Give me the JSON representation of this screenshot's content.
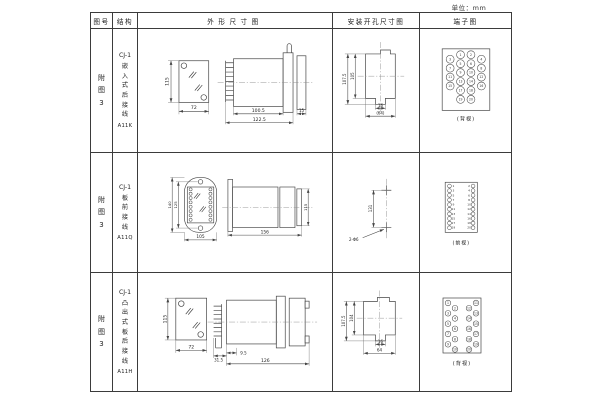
{
  "page": {
    "unit_label": "单位：mm"
  },
  "header": {
    "fig_no": "图号",
    "structure": "结构",
    "outline": "外形尺寸图",
    "mounting": "安装开孔尺寸图",
    "terminal": "端子图"
  },
  "rows": [
    {
      "fig": "附图3",
      "model": "CJ-1",
      "structure": "嵌入式后接线",
      "code": "A11K",
      "view_label": "(背视)",
      "dims": {
        "front_h": "115",
        "front_w": "72",
        "body": "100.5",
        "total": "122.5",
        "panel": "15",
        "cut_h1": "107.5",
        "cut_h2": "105",
        "slot": "16",
        "cut_w": "(64)"
      }
    },
    {
      "fig": "附图3",
      "model": "CJ-1",
      "structure": "板前接线",
      "code": "A11Q",
      "view_label": "(前视)",
      "dims": {
        "front_h1": "140",
        "front_h2": "125",
        "front_w": "105",
        "depth": "156",
        "side_h": "115",
        "hole_span": "131",
        "holes": "2-Φ6"
      }
    },
    {
      "fig": "附图3",
      "model": "CJ-1",
      "structure": "凸出式板后接线",
      "code": "A11H",
      "view_label": "(背视)",
      "dims": {
        "front_h": "115",
        "front_w": "72",
        "stud": "31.5",
        "offset": "9.5",
        "body": "126",
        "cut_h1": "107.5",
        "cut_h2": "104",
        "slot": "16",
        "cut_w": "64"
      }
    }
  ],
  "terminals": {
    "a11k_rear": [
      "1",
      "2",
      "3",
      "4",
      "5",
      "6",
      "7",
      "8",
      "9",
      "10",
      "11",
      "12",
      "13",
      "14",
      "15",
      "16",
      "17",
      "18",
      "19",
      "20"
    ],
    "a11q_left": [
      "1",
      "3",
      "5",
      "7",
      "9",
      "11",
      "13",
      "15",
      "17",
      "19"
    ],
    "a11q_right": [
      "2",
      "4",
      "6",
      "8",
      "10",
      "12",
      "14",
      "16",
      "18",
      "20"
    ],
    "a11h_rear": [
      "1",
      "2",
      "3",
      "4",
      "5",
      "6",
      "7",
      "8",
      "9",
      "10",
      "11",
      "12",
      "13",
      "14",
      "15",
      "16",
      "17",
      "18",
      "19",
      "20"
    ]
  }
}
